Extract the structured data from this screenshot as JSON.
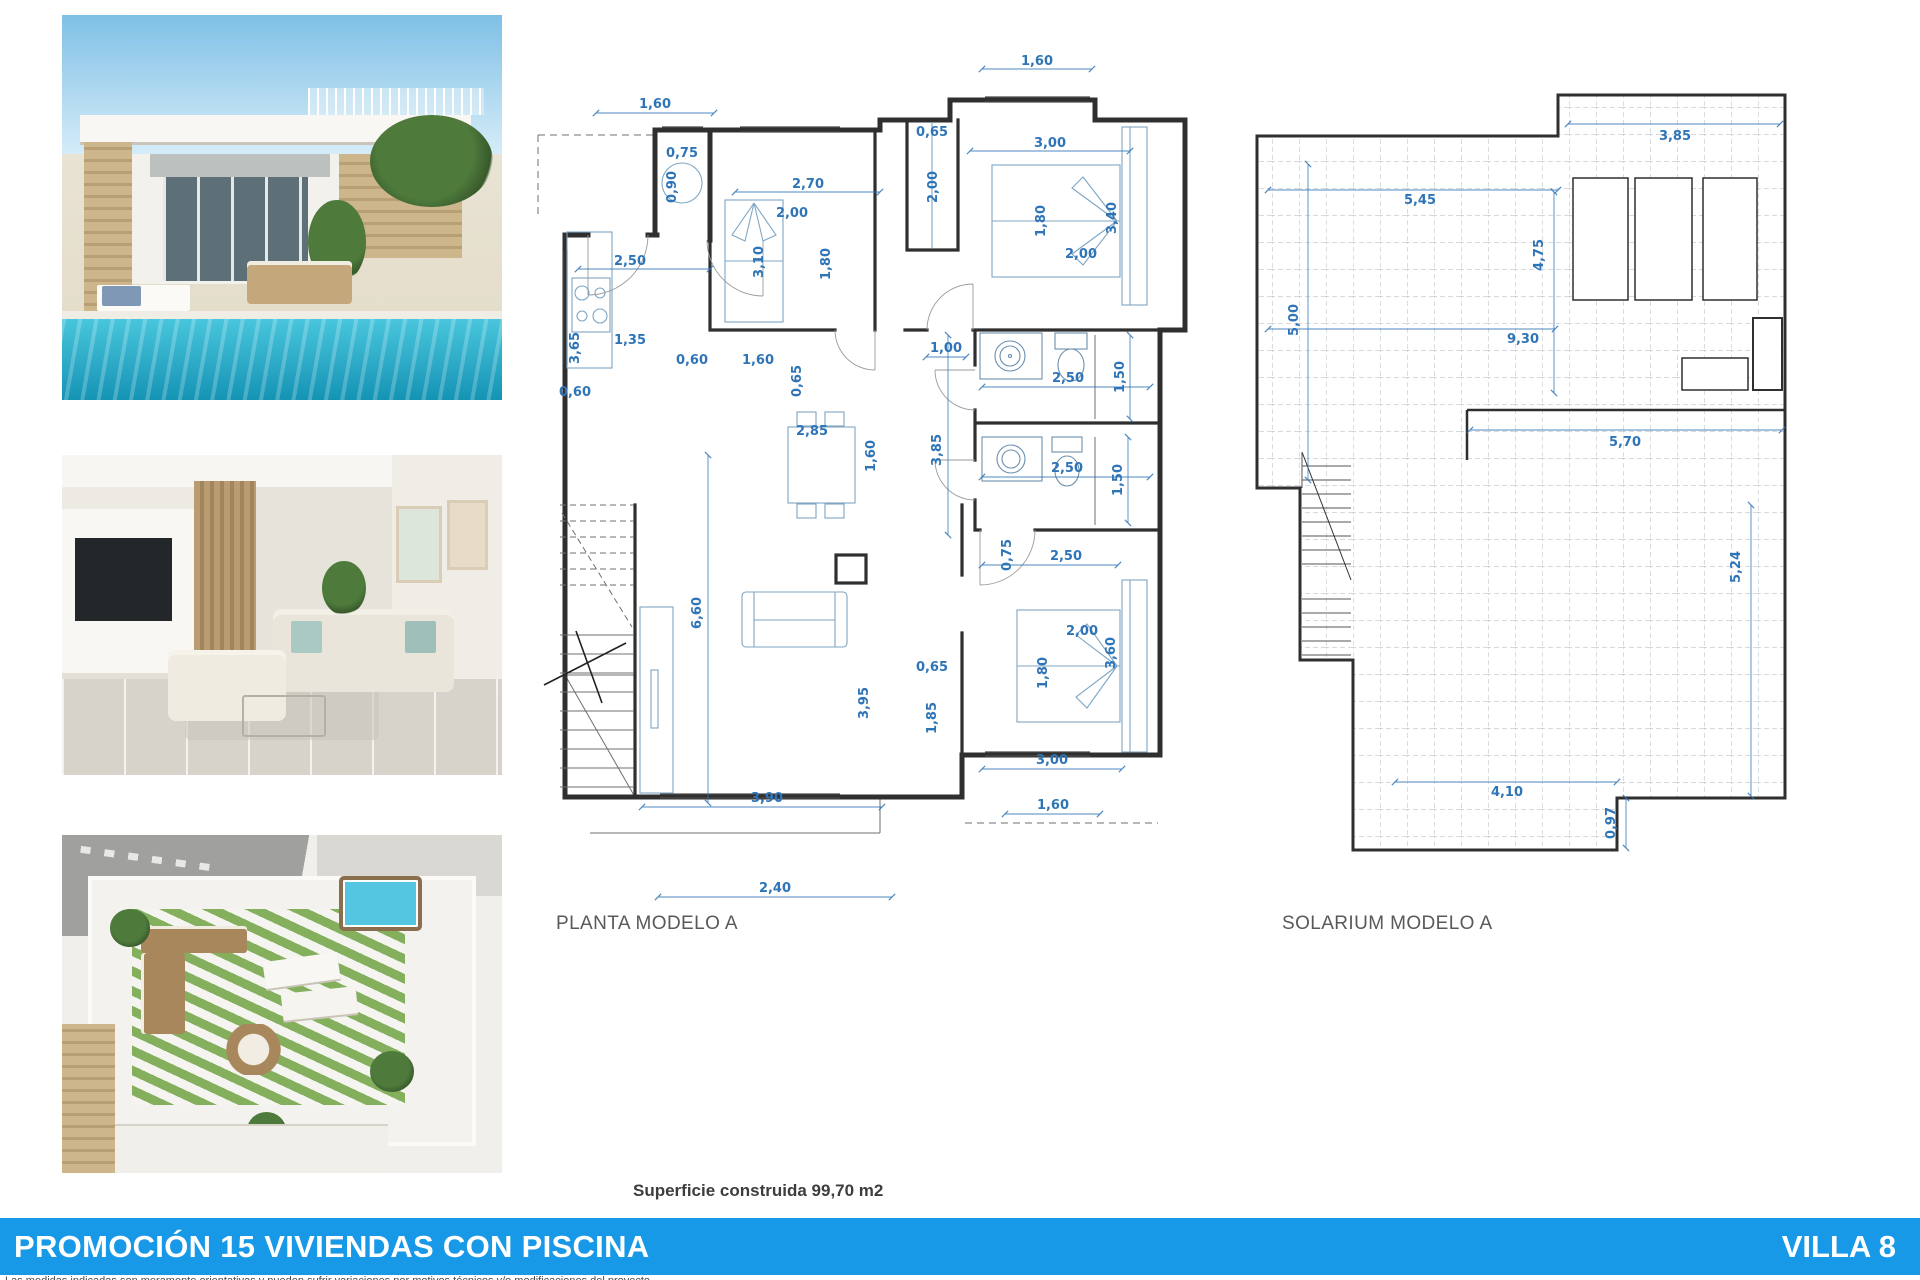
{
  "photos": {
    "exterior": {
      "name": "villa-exterior-pool"
    },
    "interior": {
      "name": "living-room-interior"
    },
    "rooftop": {
      "name": "rooftop-solarium-view"
    }
  },
  "planta": {
    "label": "PLANTA MODELO A",
    "dims": [
      {
        "t": "1,60",
        "x": 125,
        "y": 73,
        "r": 0
      },
      {
        "t": "0,75",
        "x": 152,
        "y": 122,
        "r": 0
      },
      {
        "t": "0,90",
        "x": 146,
        "y": 152,
        "r": 1
      },
      {
        "t": "1,60",
        "x": 507,
        "y": 30,
        "r": 0
      },
      {
        "t": "0,65",
        "x": 402,
        "y": 101,
        "r": 0
      },
      {
        "t": "2,00",
        "x": 407,
        "y": 152,
        "r": 1
      },
      {
        "t": "2,70",
        "x": 278,
        "y": 153,
        "r": 0
      },
      {
        "t": "2,00",
        "x": 262,
        "y": 182,
        "r": 0
      },
      {
        "t": "3,10",
        "x": 233,
        "y": 227,
        "r": 1
      },
      {
        "t": "1,80",
        "x": 300,
        "y": 229,
        "r": 1
      },
      {
        "t": "3,00",
        "x": 520,
        "y": 112,
        "r": 0
      },
      {
        "t": "1,80",
        "x": 515,
        "y": 186,
        "r": 1
      },
      {
        "t": "3,40",
        "x": 586,
        "y": 183,
        "r": 1
      },
      {
        "t": "2,00",
        "x": 551,
        "y": 223,
        "r": 0
      },
      {
        "t": "2,50",
        "x": 100,
        "y": 230,
        "r": 0
      },
      {
        "t": "3,65",
        "x": 49,
        "y": 313,
        "r": 1
      },
      {
        "t": "1,35",
        "x": 100,
        "y": 309,
        "r": 0
      },
      {
        "t": "0,60",
        "x": 162,
        "y": 329,
        "r": 0
      },
      {
        "t": "1,60",
        "x": 228,
        "y": 329,
        "r": 0
      },
      {
        "t": "0,65",
        "x": 271,
        "y": 346,
        "r": 1
      },
      {
        "t": "0,60",
        "x": 45,
        "y": 361,
        "r": 0
      },
      {
        "t": "1,00",
        "x": 416,
        "y": 317,
        "r": 0
      },
      {
        "t": "2,50",
        "x": 538,
        "y": 347,
        "r": 0
      },
      {
        "t": "1,50",
        "x": 594,
        "y": 342,
        "r": 1
      },
      {
        "t": "2,85",
        "x": 282,
        "y": 400,
        "r": 0
      },
      {
        "t": "1,60",
        "x": 345,
        "y": 421,
        "r": 1
      },
      {
        "t": "3,85",
        "x": 411,
        "y": 415,
        "r": 1
      },
      {
        "t": "2,50",
        "x": 537,
        "y": 437,
        "r": 0
      },
      {
        "t": "1,50",
        "x": 592,
        "y": 445,
        "r": 1
      },
      {
        "t": "0,75",
        "x": 481,
        "y": 520,
        "r": 1
      },
      {
        "t": "2,50",
        "x": 536,
        "y": 525,
        "r": 0
      },
      {
        "t": "6,60",
        "x": 171,
        "y": 578,
        "r": 1
      },
      {
        "t": "2,00",
        "x": 552,
        "y": 600,
        "r": 0
      },
      {
        "t": "1,80",
        "x": 517,
        "y": 638,
        "r": 1
      },
      {
        "t": "3,60",
        "x": 585,
        "y": 618,
        "r": 1
      },
      {
        "t": "0,65",
        "x": 402,
        "y": 636,
        "r": 0
      },
      {
        "t": "1,85",
        "x": 406,
        "y": 683,
        "r": 1
      },
      {
        "t": "3,95",
        "x": 338,
        "y": 668,
        "r": 1
      },
      {
        "t": "3,00",
        "x": 522,
        "y": 729,
        "r": 0
      },
      {
        "t": "3,90",
        "x": 237,
        "y": 767,
        "r": 0
      },
      {
        "t": "1,60",
        "x": 523,
        "y": 774,
        "r": 0
      },
      {
        "t": "2,40",
        "x": 245,
        "y": 857,
        "r": 0
      }
    ]
  },
  "solarium": {
    "label": "SOLARIUM MODELO A",
    "dims": [
      {
        "t": "3,85",
        "x": 430,
        "y": 60,
        "r": 0
      },
      {
        "t": "5,45",
        "x": 175,
        "y": 124,
        "r": 0
      },
      {
        "t": "4,75",
        "x": 298,
        "y": 175,
        "r": 1
      },
      {
        "t": "5,00",
        "x": 53,
        "y": 240,
        "r": 1
      },
      {
        "t": "9,30",
        "x": 278,
        "y": 263,
        "r": 0
      },
      {
        "t": "5,70",
        "x": 380,
        "y": 366,
        "r": 0
      },
      {
        "t": "5,24",
        "x": 495,
        "y": 487,
        "r": 1
      },
      {
        "t": "4,10",
        "x": 262,
        "y": 716,
        "r": 0
      },
      {
        "t": "0,97",
        "x": 370,
        "y": 743,
        "r": 1
      }
    ]
  },
  "footer": {
    "superficie": "Superficie construida 99,70 m2",
    "banner_title": "PROMOCIÓN 15 VIVIENDAS CON PISCINA",
    "banner_villa": "VILLA 8",
    "banner_color": "#1899E8",
    "disclaimer": "Las medidas indicadas son meramente orientativas y pueden sufrir variaciones por motivos técnicos y/o modificaciones del proyecto."
  },
  "colors": {
    "dim_blue": "#2E74B6",
    "wall": "#2f2f2f",
    "label_gray": "#595959"
  }
}
